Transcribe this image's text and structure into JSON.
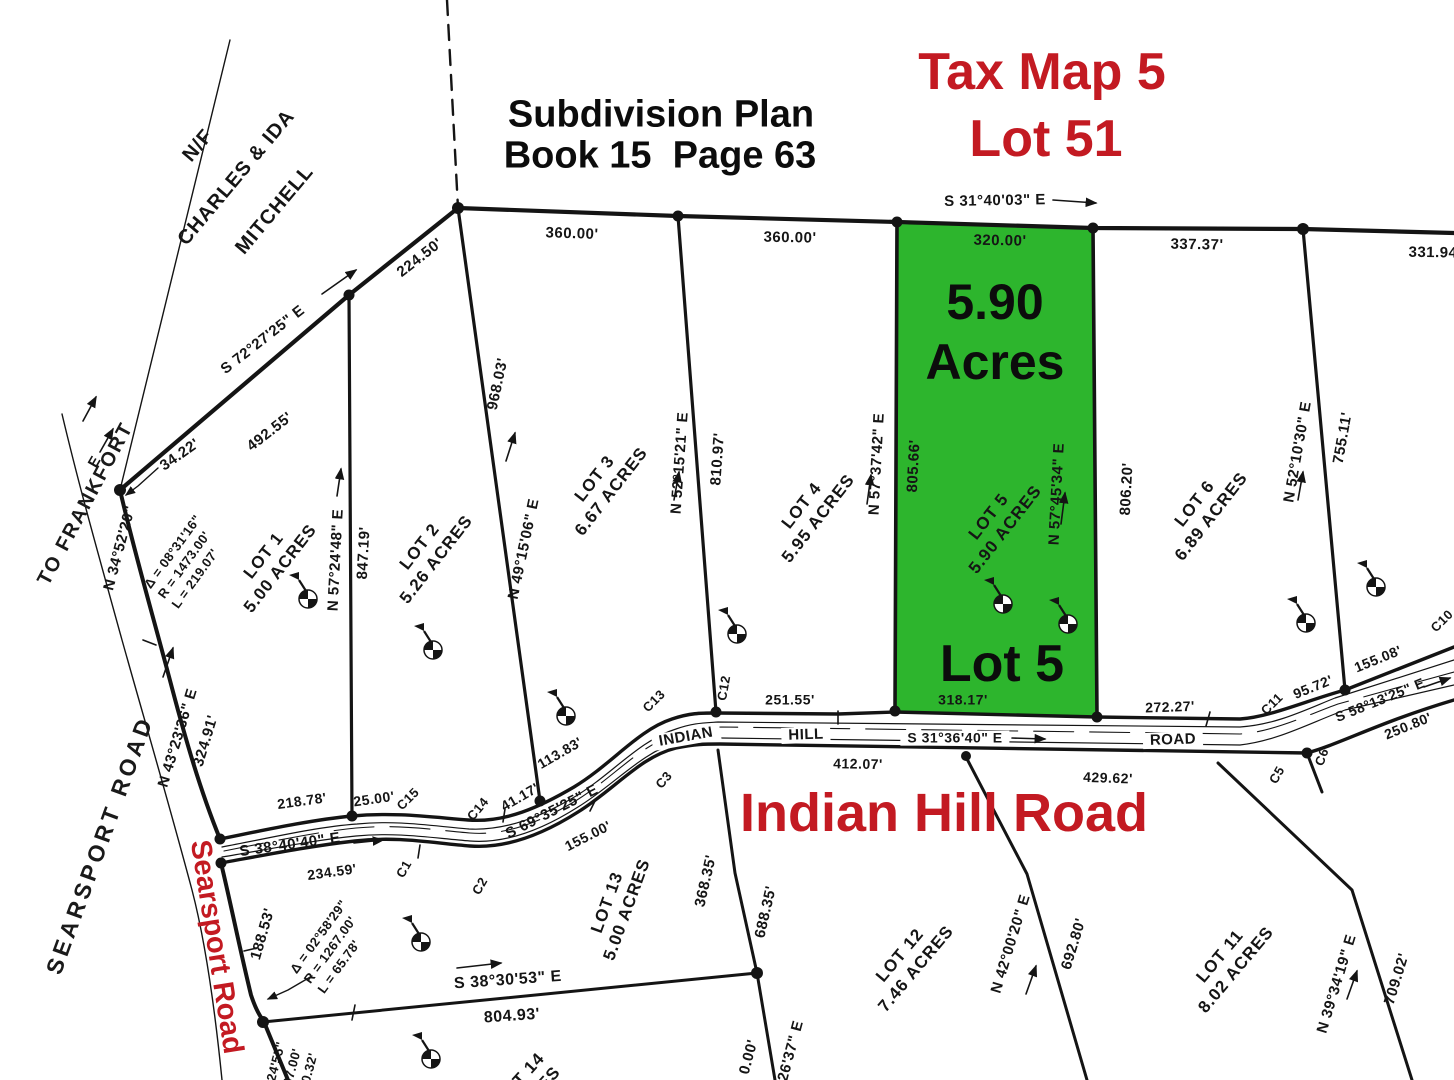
{
  "colors": {
    "red": "#c31a22",
    "green": "#2db52d",
    "ink": "#141414"
  },
  "header": {
    "plan_line1": "Subdivision Plan",
    "plan_line2": "Book 15  Page 63",
    "tax_line1": "Tax Map 5",
    "tax_line2": "Lot 51"
  },
  "green_lot": {
    "area_line1": "5.90",
    "area_line2": "Acres",
    "name": "Lot 5"
  },
  "banners": {
    "indian_hill": "Indian Hill Road",
    "searsport": "Searsport Road"
  },
  "abutter": {
    "line1": "N/F",
    "line2": "CHARLES & IDA",
    "line3": "MITCHELL"
  },
  "road_text": {
    "searsport_outline": "SEARSPORT ROAD",
    "to_frankfort": "TO FRANKFORT"
  },
  "labels": [
    {
      "t": "S 31°40'03\" E",
      "x": 995,
      "y": 201,
      "r": -1,
      "s": 15
    },
    {
      "t": "360.00'",
      "x": 572,
      "y": 234,
      "r": 2,
      "s": 15
    },
    {
      "t": "360.00'",
      "x": 790,
      "y": 238,
      "r": 1,
      "s": 15
    },
    {
      "t": "320.00'",
      "x": 1000,
      "y": 241,
      "r": 1,
      "s": 15
    },
    {
      "t": "337.37'",
      "x": 1197,
      "y": 245,
      "r": 1,
      "s": 15
    },
    {
      "t": "331.94",
      "x": 1433,
      "y": 253,
      "r": 1,
      "s": 15
    },
    {
      "t": "224.50'",
      "x": 420,
      "y": 258,
      "r": -38,
      "s": 15
    },
    {
      "t": "S 72°27'25\" E",
      "x": 263,
      "y": 340,
      "r": -38,
      "s": 15
    },
    {
      "t": "492.55'",
      "x": 270,
      "y": 432,
      "r": -38,
      "s": 15
    },
    {
      "t": "34.22'",
      "x": 180,
      "y": 455,
      "r": -35,
      "s": 15
    },
    {
      "t": "N 34°52'20\"",
      "x": 120,
      "y": 548,
      "r": -75,
      "s": 15
    },
    {
      "t": "E",
      "x": 95,
      "y": 462,
      "r": -60,
      "s": 15
    },
    {
      "t": "N 43°23'36\" E",
      "x": 178,
      "y": 738,
      "r": -73,
      "s": 15
    },
    {
      "t": "324.91'",
      "x": 206,
      "y": 741,
      "r": -73,
      "s": 15
    },
    {
      "t": "218.78'",
      "x": 302,
      "y": 801,
      "r": -8,
      "s": 14
    },
    {
      "t": "25.00'",
      "x": 374,
      "y": 799,
      "r": -8,
      "s": 14
    },
    {
      "t": "C15",
      "x": 408,
      "y": 799,
      "r": -45,
      "s": 13
    },
    {
      "t": "S 38°40'40\" E",
      "x": 290,
      "y": 845,
      "r": -8,
      "s": 15
    },
    {
      "t": "234.59'",
      "x": 332,
      "y": 872,
      "r": -8,
      "s": 14
    },
    {
      "t": "188.53'",
      "x": 263,
      "y": 934,
      "r": -74,
      "s": 15
    },
    {
      "t": "C14",
      "x": 478,
      "y": 809,
      "r": -50,
      "s": 13
    },
    {
      "t": "41.17'",
      "x": 520,
      "y": 797,
      "r": -30,
      "s": 14
    },
    {
      "t": "113.83'",
      "x": 560,
      "y": 753,
      "r": -30,
      "s": 14
    },
    {
      "t": "S 69°35'25\" E",
      "x": 552,
      "y": 812,
      "r": -27,
      "s": 15
    },
    {
      "t": "155.00'",
      "x": 588,
      "y": 836,
      "r": -27,
      "s": 14
    },
    {
      "t": "C3",
      "x": 664,
      "y": 780,
      "r": -50,
      "s": 13
    },
    {
      "t": "C13",
      "x": 654,
      "y": 701,
      "r": -45,
      "s": 13
    },
    {
      "t": "C12",
      "x": 724,
      "y": 688,
      "r": -80,
      "s": 13
    },
    {
      "t": "251.55'",
      "x": 790,
      "y": 700,
      "r": 0,
      "s": 14
    },
    {
      "t": "INDIAN",
      "x": 686,
      "y": 737,
      "r": -10,
      "s": 15,
      "bg": 1
    },
    {
      "t": "HILL",
      "x": 806,
      "y": 735,
      "r": -2,
      "s": 15,
      "bg": 1
    },
    {
      "t": "S 31°36'40\" E",
      "x": 955,
      "y": 738,
      "r": 0,
      "s": 14,
      "bg": 1
    },
    {
      "t": "ROAD",
      "x": 1173,
      "y": 740,
      "r": -2,
      "s": 15,
      "bg": 1
    },
    {
      "t": "412.07'",
      "x": 858,
      "y": 764,
      "r": 1,
      "s": 14
    },
    {
      "t": "429.62'",
      "x": 1108,
      "y": 778,
      "r": 2,
      "s": 14
    },
    {
      "t": "318.17'",
      "x": 963,
      "y": 700,
      "r": 0,
      "s": 14
    },
    {
      "t": "272.27'",
      "x": 1170,
      "y": 707,
      "r": -2,
      "s": 14
    },
    {
      "t": "95.72'",
      "x": 1313,
      "y": 687,
      "r": -22,
      "s": 14
    },
    {
      "t": "C11",
      "x": 1272,
      "y": 704,
      "r": -45,
      "s": 13
    },
    {
      "t": "155.08'",
      "x": 1378,
      "y": 659,
      "r": -22,
      "s": 14
    },
    {
      "t": "S 58°13'25\" E",
      "x": 1380,
      "y": 700,
      "r": -22,
      "s": 14
    },
    {
      "t": "250.80'",
      "x": 1408,
      "y": 726,
      "r": -22,
      "s": 14
    },
    {
      "t": "C5",
      "x": 1277,
      "y": 775,
      "r": -60,
      "s": 13
    },
    {
      "t": "C6",
      "x": 1322,
      "y": 757,
      "r": -70,
      "s": 13
    },
    {
      "t": "C10",
      "x": 1442,
      "y": 621,
      "r": -45,
      "s": 13
    },
    {
      "t": "C1",
      "x": 404,
      "y": 869,
      "r": -60,
      "s": 13
    },
    {
      "t": "C2",
      "x": 480,
      "y": 886,
      "r": -60,
      "s": 13
    },
    {
      "t": "N 57°24'48\" E",
      "x": 336,
      "y": 560,
      "r": -87,
      "s": 15
    },
    {
      "t": "847.19'",
      "x": 364,
      "y": 553,
      "r": -87,
      "s": 15
    },
    {
      "t": "N 49°15'06\" E",
      "x": 524,
      "y": 549,
      "r": -78,
      "s": 15
    },
    {
      "t": "968.03'",
      "x": 498,
      "y": 384,
      "r": -78,
      "s": 15
    },
    {
      "t": "N 52°15'21\" E",
      "x": 680,
      "y": 463,
      "r": -86,
      "s": 15
    },
    {
      "t": "810.97'",
      "x": 718,
      "y": 459,
      "r": -86,
      "s": 15
    },
    {
      "t": "N 57°37'42\" E",
      "x": 877,
      "y": 464,
      "r": -87,
      "s": 15
    },
    {
      "t": "805.66'",
      "x": 914,
      "y": 466,
      "r": -87,
      "s": 15
    },
    {
      "t": "N 57°45'34\" E",
      "x": 1057,
      "y": 494,
      "r": -87,
      "s": 15
    },
    {
      "t": "806.20'",
      "x": 1127,
      "y": 489,
      "r": -87,
      "s": 15
    },
    {
      "t": "N 52°10'30\" E",
      "x": 1298,
      "y": 452,
      "r": -80,
      "s": 15
    },
    {
      "t": "755.11'",
      "x": 1343,
      "y": 438,
      "r": -80,
      "s": 15
    },
    {
      "t": "368.35'",
      "x": 706,
      "y": 881,
      "r": -77,
      "s": 15
    },
    {
      "t": "688.35'",
      "x": 766,
      "y": 912,
      "r": -77,
      "s": 15
    },
    {
      "t": "S 38°30'53\" E",
      "x": 508,
      "y": 981,
      "r": -4,
      "s": 16
    },
    {
      "t": "804.93'",
      "x": 512,
      "y": 1017,
      "r": -4,
      "s": 16
    },
    {
      "t": "N 42°00'20\" E",
      "x": 1011,
      "y": 944,
      "r": -73,
      "s": 15
    },
    {
      "t": "692.80'",
      "x": 1074,
      "y": 944,
      "r": -73,
      "s": 15
    },
    {
      "t": "N 39°34'19\" E",
      "x": 1337,
      "y": 984,
      "r": -73,
      "s": 15
    },
    {
      "t": "709.02'",
      "x": 1397,
      "y": 979,
      "r": -73,
      "s": 15
    },
    {
      "t": "26'37\" E",
      "x": 791,
      "y": 1051,
      "r": -75,
      "s": 15
    },
    {
      "t": "0.00'",
      "x": 749,
      "y": 1057,
      "r": -75,
      "s": 15
    }
  ],
  "lots": [
    {
      "name": "LOT 1",
      "acres": "5.00 ACRES",
      "x": 272,
      "y": 562,
      "r": -52
    },
    {
      "name": "LOT 2",
      "acres": "5.26 ACRES",
      "x": 428,
      "y": 553,
      "r": -52
    },
    {
      "name": "LOT 3",
      "acres": "6.67 ACRES",
      "x": 603,
      "y": 485,
      "r": -52
    },
    {
      "name": "LOT 4",
      "acres": "5.95 ACRES",
      "x": 810,
      "y": 512,
      "r": -52
    },
    {
      "name": "LOT 5",
      "acres": "5.90 ACRES",
      "x": 997,
      "y": 523,
      "r": -52
    },
    {
      "name": "LOT 6",
      "acres": "6.89 ACRES",
      "x": 1203,
      "y": 510,
      "r": -52
    },
    {
      "name": "LOT 13",
      "acres": "5.00 ACRES",
      "x": 617,
      "y": 906,
      "r": -70
    },
    {
      "name": "LOT 12",
      "acres": "7.46 ACRES",
      "x": 908,
      "y": 962,
      "r": -50
    },
    {
      "name": "LOT 11",
      "acres": "8.02 ACRES",
      "x": 1228,
      "y": 963,
      "r": -50
    },
    {
      "name": "LOT 14",
      "acres": "ACRES",
      "x": 528,
      "y": 1086,
      "r": -48
    }
  ],
  "curve_blocks": [
    {
      "lines": "Δ = 08°31'16\"\nR = 1473.00'\nL = 219.07'",
      "x": 187,
      "y": 562,
      "r": -54
    },
    {
      "lines": "Δ = 02°58'29\"\nR = 1267.00'\nL = 65.78'",
      "x": 333,
      "y": 947,
      "r": -54
    },
    {
      "lines": "24'55\"\n67.00'\n50.32'",
      "x": 293,
      "y": 1066,
      "r": -75
    }
  ]
}
